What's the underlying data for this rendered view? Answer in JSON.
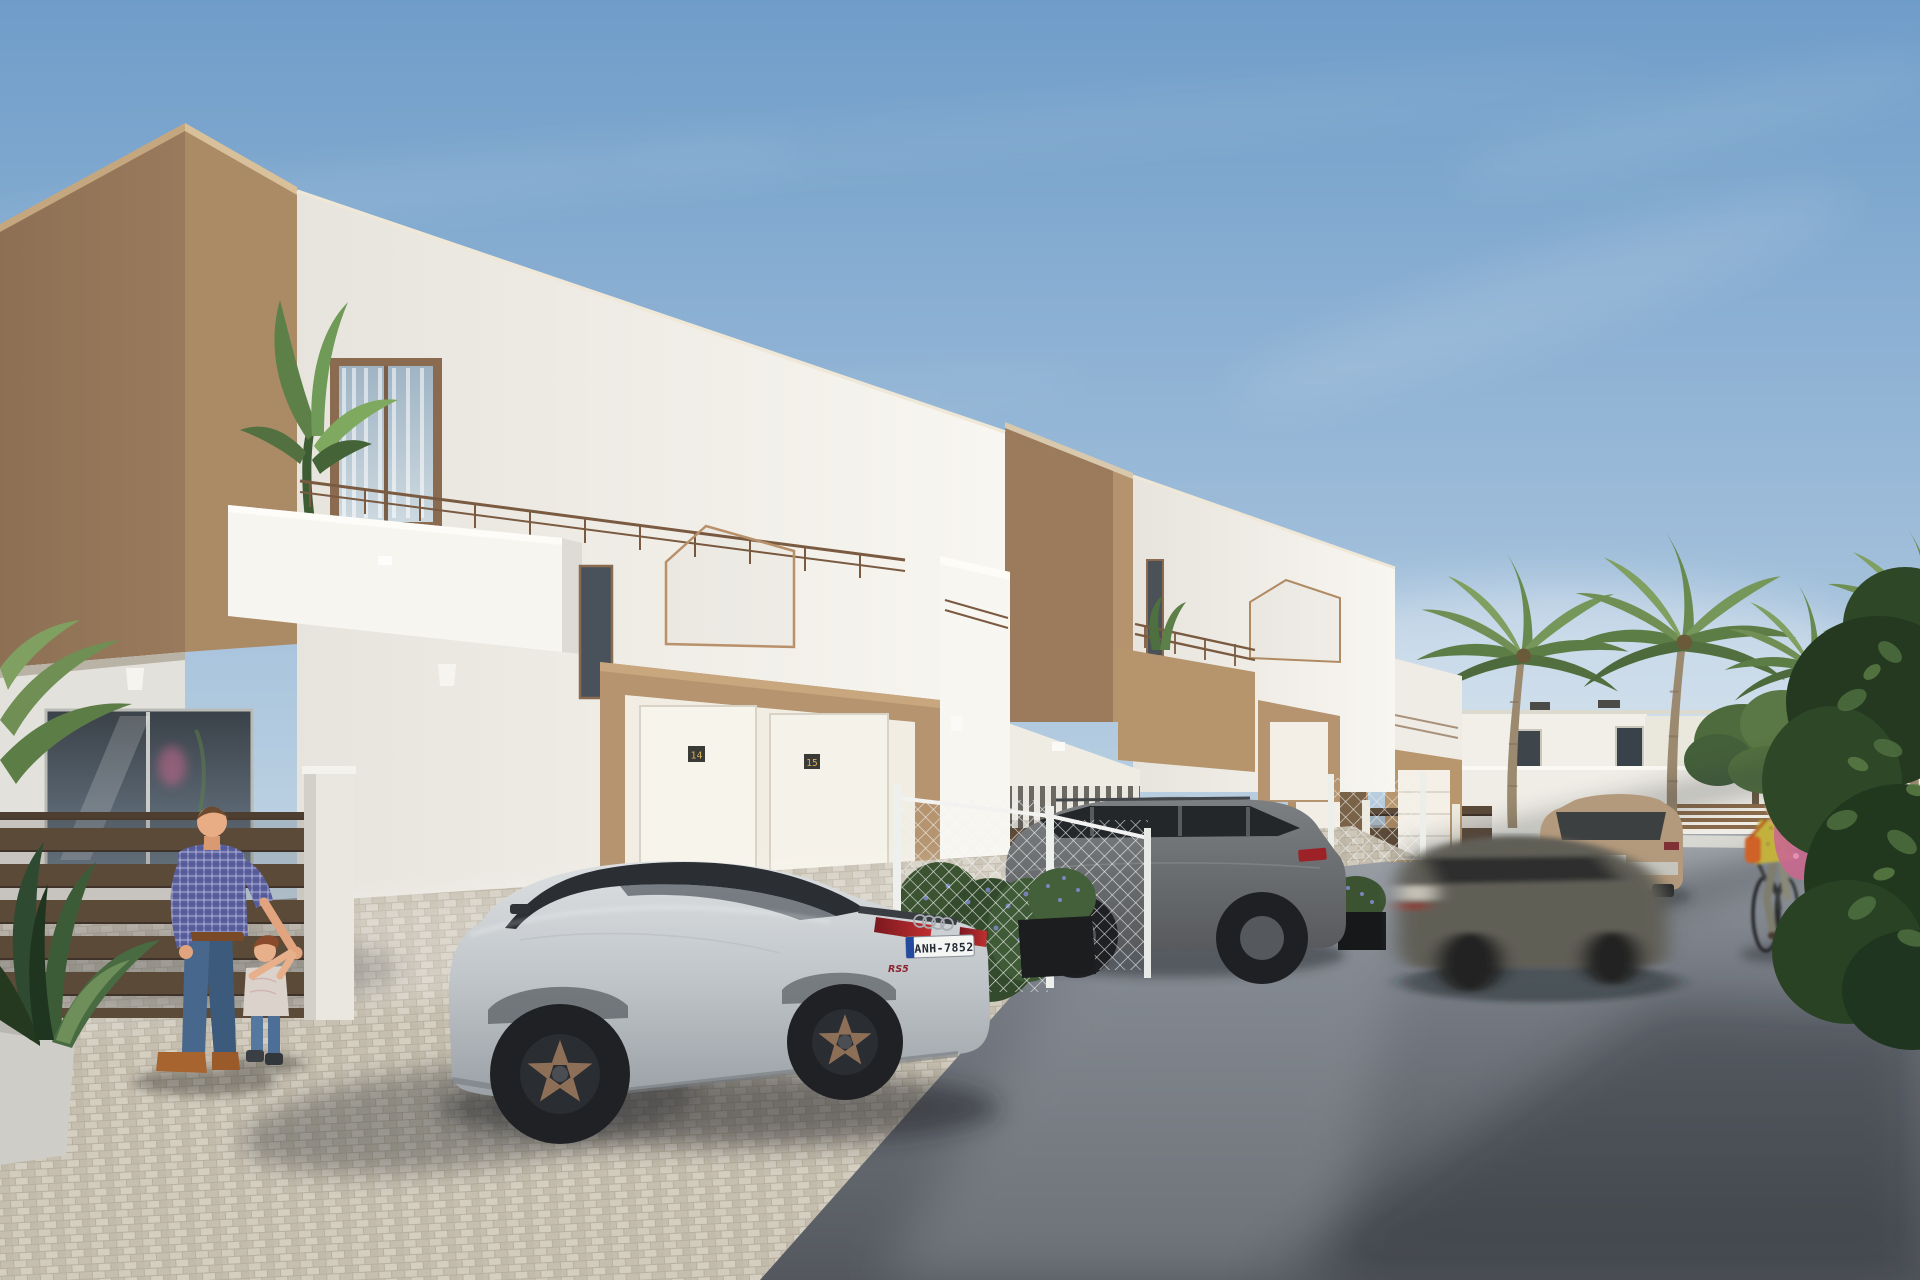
{
  "scene": {
    "type": "photorealistic architectural exterior render",
    "description": "Street view of a row of modern two-storey white townhouses with tan accent walls, flat roofs and balconies. A silver sportback is parked on a cobbled driveway, a grey SUV and a beige SUV are parked further along, a motion-blurred grey hatchback drives past, a man plays with a toddler by a slatted fence, and a woman cycles past a large flowering bush under palm trees.",
    "time_of_day": "sunny day",
    "weather": "clear sky with thin cirrus clouds"
  },
  "texts": {
    "license_plate": "ANH-7852",
    "house_number_left": "14",
    "house_number_right": "15",
    "trunk_badge": "RS5"
  },
  "icons": {
    "car_logo": "audi-four-rings"
  },
  "palette": {
    "sky_top": "#6f9dc9",
    "sky_horizon": "#c9dae6",
    "wall_white_lit": "#f6f3ec",
    "wall_white_shade": "#d9d9d6",
    "accent_tan_lit": "#b5946f",
    "accent_tan_shade": "#8d7054",
    "road_near": "#565a60",
    "road_far": "#a6abb0",
    "paver_light": "#d0cabd",
    "fence_slat_brown": "#5c4a39",
    "mesh_fence_white": "#eef0ee",
    "foliage_dark": "#24391f",
    "foliage_light": "#6f8f55",
    "bougainvillea_pink": "#c9688f",
    "car_silver": "#c7cbce",
    "car_suv_gray": "#6e7173",
    "car_moving_gray": "#615e56",
    "car_beige": "#b49a7c",
    "taillight_red": "#a02028",
    "plate_blue_band": "#234a9e",
    "plaque_gold": "#d9b054",
    "skin": "#e2a47e",
    "shirt_checker_blue": "#5a5fa0",
    "jeans_blue": "#47688c",
    "cyclist_top_yellow": "#c2b23e",
    "bag_orange": "#cf6228"
  },
  "objects": {
    "buildings": [
      {
        "label": "townhouse-1 foreground, tan accent wall, balcony with banana plant, entrance portal with units 14 and 15"
      },
      {
        "label": "townhouse-2 middle, same design, grey SUV in driveway"
      },
      {
        "label": "townhouse-3 far, same design, small garages and slat fences"
      },
      {
        "label": "background white houses behind boundary wall"
      }
    ],
    "vehicles": [
      {
        "label": "silver sportback parked on driveway",
        "plate": "ANH-7852",
        "badge": "RS5"
      },
      {
        "label": "grey SUV parked behind wire mesh fence"
      },
      {
        "label": "grey hatchback driving, motion blurred"
      },
      {
        "label": "beige SUV parked along street"
      }
    ],
    "people": [
      {
        "label": "man in checkered shirt playing with toddler"
      },
      {
        "label": "woman cycling in yellow blouse with orange bag"
      }
    ],
    "vegetation": [
      {
        "label": "banana plant on balcony"
      },
      {
        "label": "four palm trees in background"
      },
      {
        "label": "green tree behind boundary wall"
      },
      {
        "label": "large roadside bush with pink bougainvillea"
      },
      {
        "label": "potted plant in left foreground"
      },
      {
        "label": "flowering shrubs and black planter boxes along fences"
      }
    ]
  }
}
